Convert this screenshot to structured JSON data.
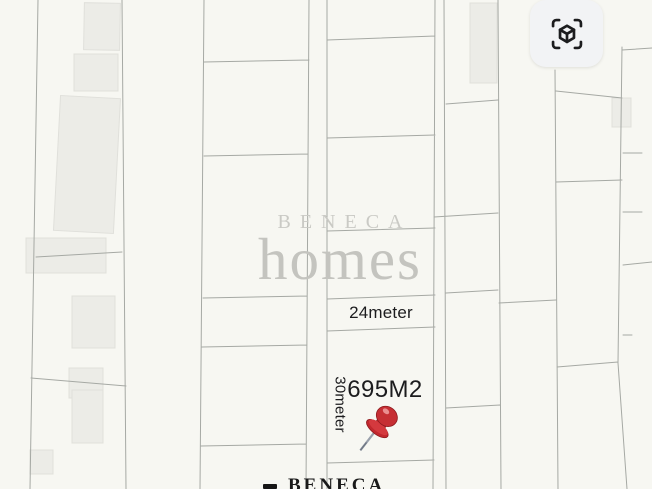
{
  "app": {
    "view_name": "plot-map"
  },
  "toolbar": {
    "view_3d_button": {
      "icon": "cube-scan-icon"
    }
  },
  "watermark": {
    "brand_top": "BENECA",
    "brand_bottom": "homes"
  },
  "plot": {
    "width_label": "24meter",
    "area_label": "695M2",
    "depth_label": "30meter",
    "marker_icon": "red-pushpin-icon"
  },
  "footer_logo": {
    "brand": "BENECA"
  },
  "colors": {
    "map_background": "#f7f7f2",
    "parcel_line": "#a6a9a4",
    "building_fill": "#ececе7",
    "watermark_gray": "#c8c8c3",
    "label_text": "#1c1c1e",
    "pin_red": "#c1272d",
    "button_background": "#f2f3f5",
    "icon_dark": "#1c1c1e"
  }
}
